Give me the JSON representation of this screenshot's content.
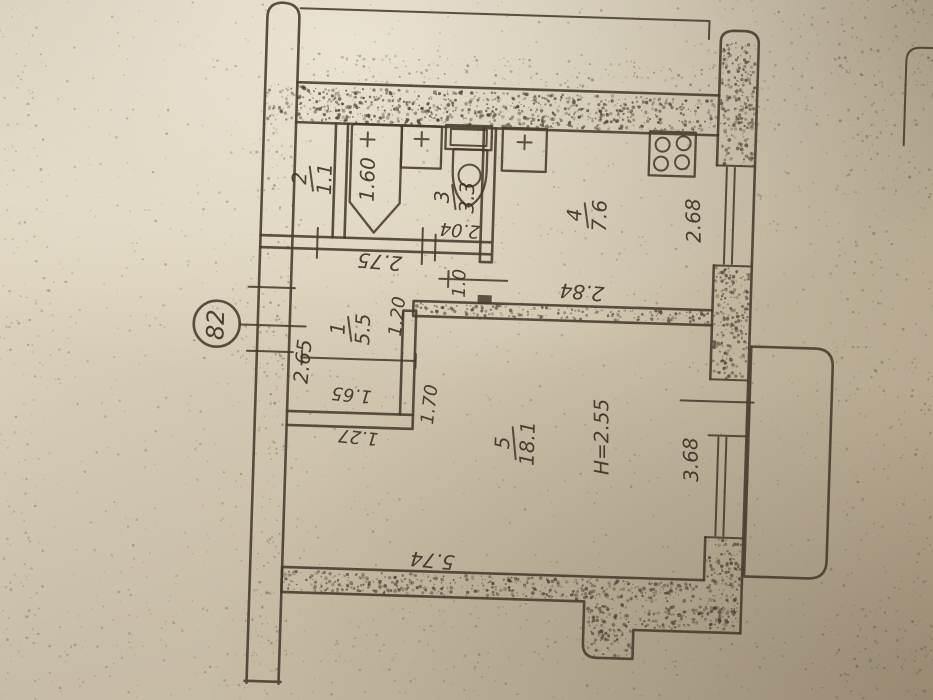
{
  "plan": {
    "apartment_number": "82",
    "ceiling_height_label": "H=2.55",
    "rooms": {
      "hallway": {
        "number": "1",
        "area": "5.5"
      },
      "toilet": {
        "number": "2",
        "area": "1.1"
      },
      "bathroom": {
        "number": "3",
        "area": "3.3"
      },
      "kitchen": {
        "number": "4",
        "area": "7.6"
      },
      "living": {
        "number": "5",
        "area": "18.1"
      }
    },
    "dimensions": {
      "bathtub_length": "1.60",
      "bathroom_width": "2.04",
      "hallway_top": "2.75",
      "kitchen_door": "1.0",
      "kitchen_side": "2.68",
      "kitchen_bottom": "2.84",
      "hallway_left": "2.65",
      "hallway_inner_top": "1.20",
      "living_door_side": "1.70",
      "hallway_lower": "1.65",
      "living_nook": "1.27",
      "balcony_side": "3.68",
      "living_bottom": "5.74"
    },
    "fixtures": [
      "bathtub",
      "wash-basin",
      "toilet",
      "kitchen-sink",
      "stove",
      "balcony"
    ],
    "colors": {
      "paper": "#d7ccb5",
      "ink": "#453a2c"
    }
  }
}
